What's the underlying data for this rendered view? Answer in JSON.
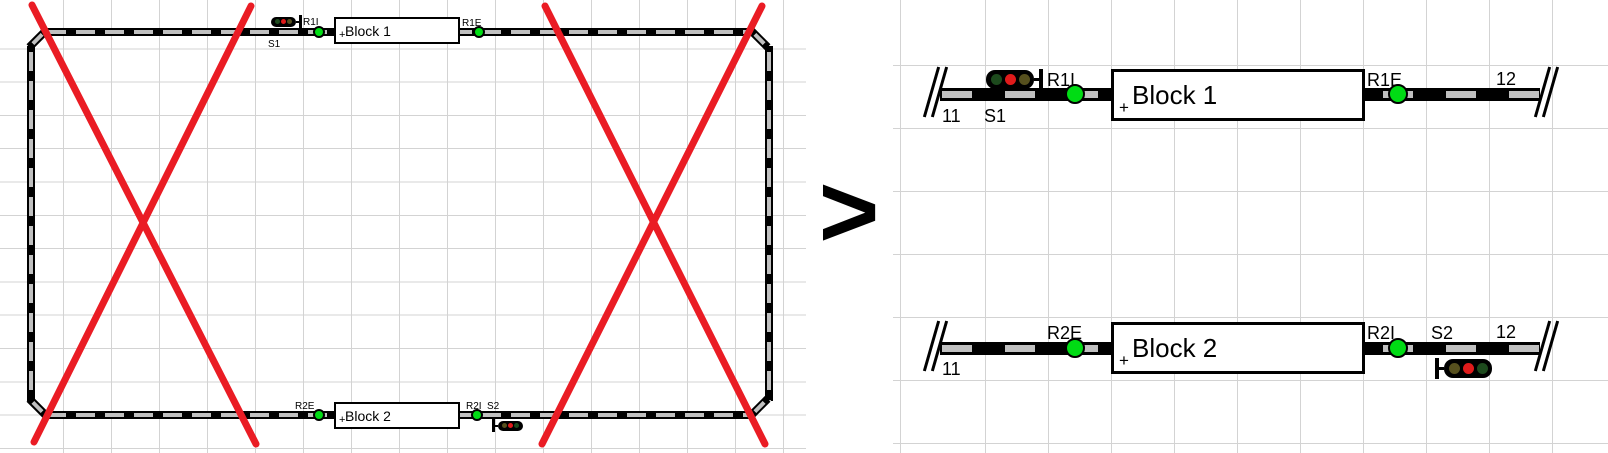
{
  "transform_symbol": ">",
  "colors": {
    "red_cross": "#ea1c24",
    "grid_line": "#d3d3d3",
    "track_black": "#000000",
    "sleeper_gray": "#c0c0c0",
    "sensor_green": "#00dc14",
    "signal_lit_red": "#e01b1b",
    "signal_unlit_green": "#1d4a1d",
    "signal_unlit_yellow": "#56501e"
  },
  "left_plan": {
    "block1": {
      "label": "Block 1",
      "orientation_mark": "+"
    },
    "block2": {
      "label": "Block 2",
      "orientation_mark": "+"
    },
    "labels": {
      "s1": "S1",
      "r1i": "R1I",
      "r1e": "R1E",
      "r2e": "R2E",
      "r2i": "R2I",
      "s2": "S2"
    }
  },
  "right_plan": {
    "top_row": {
      "end_left": "11",
      "signal": "S1",
      "sensor_enter": "R1I",
      "block": {
        "label": "Block 1",
        "orientation_mark": "+"
      },
      "sensor_exit": "R1E",
      "end_right": "12"
    },
    "bottom_row": {
      "end_left": "11",
      "sensor_enter": "R2E",
      "block": {
        "label": "Block 2",
        "orientation_mark": "+"
      },
      "sensor_exit": "R2I",
      "signal": "S2",
      "end_right": "12"
    }
  }
}
